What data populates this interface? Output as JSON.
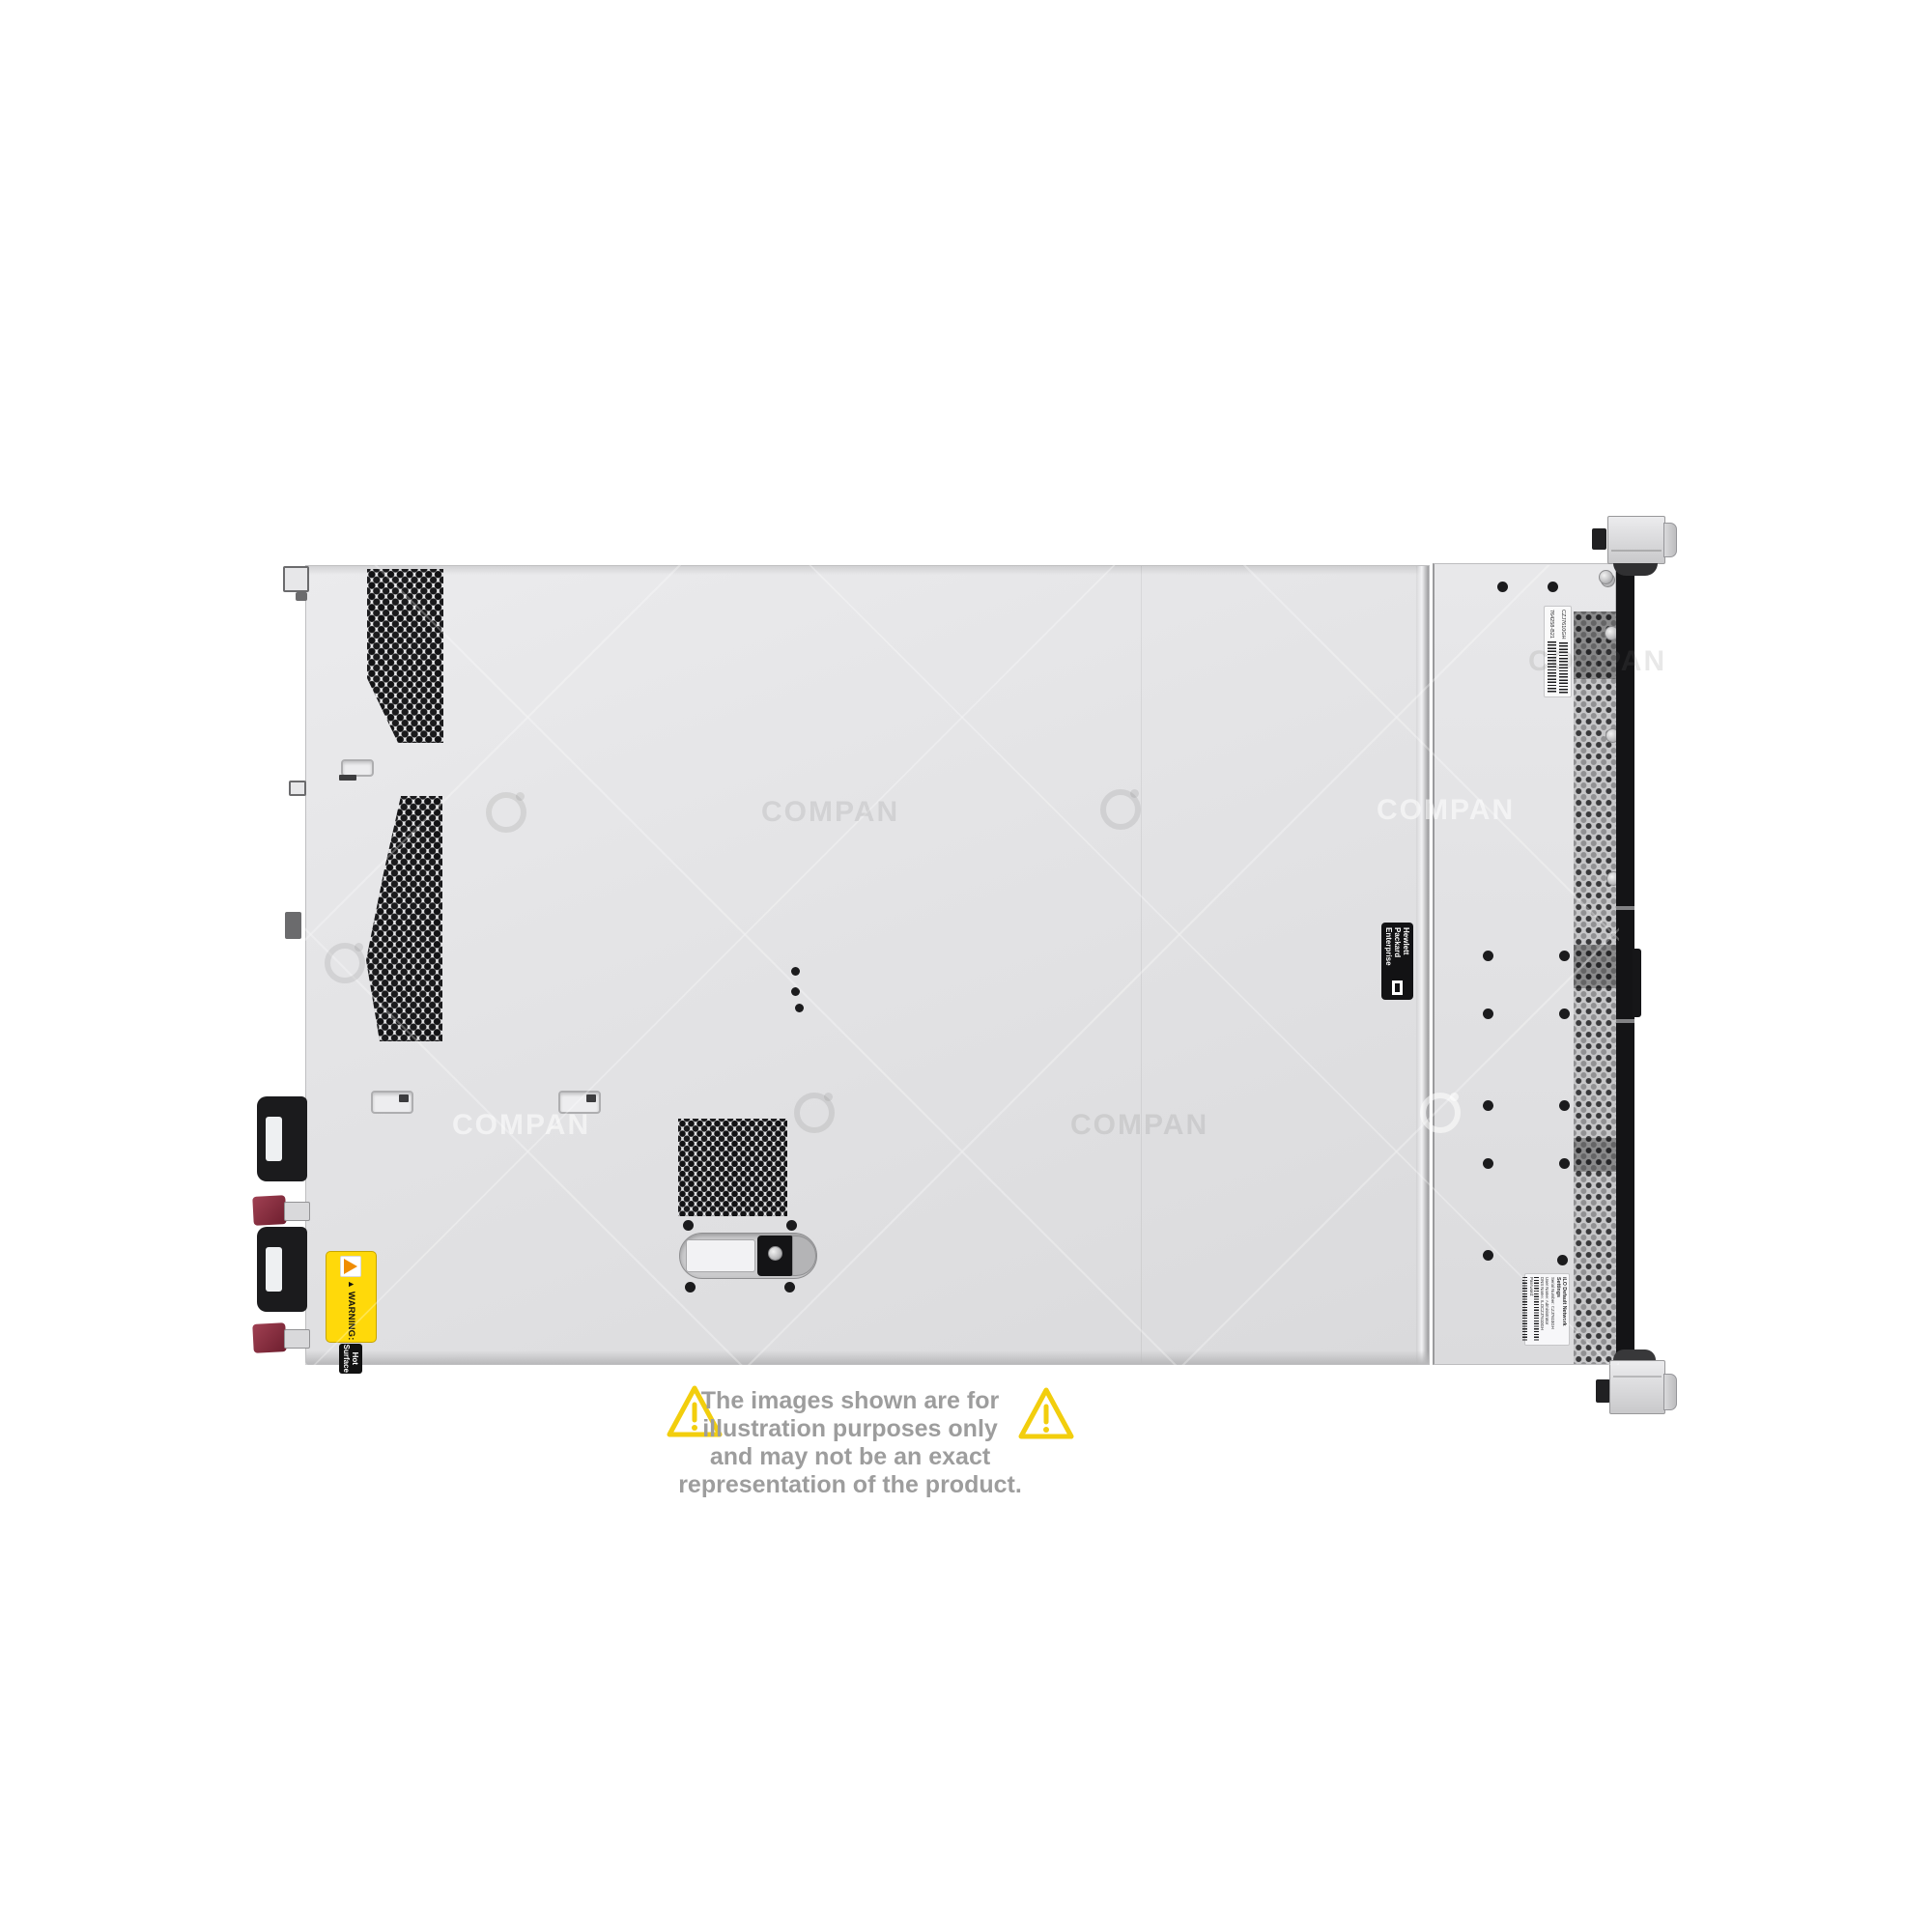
{
  "product_photo": {
    "description": "HPE 1U rack server, top view, rotated with front panel at right",
    "chassis_color": "#e3e3e5",
    "bezel_color": "#141416",
    "accent_yellow": "#ffd90a",
    "handle_maroon": "#8e3242"
  },
  "labels": {
    "warning": {
      "title": "WARNING:",
      "subtitle": "Hot Surface"
    },
    "hpe": {
      "line1": "Hewlett Packard",
      "line2": "Enterprise"
    },
    "barcode_label": {
      "serial": "CZJ7610GH",
      "part": "764258-B21"
    },
    "ilo": {
      "title": "iLO Default Network Settings",
      "line1": "Serial Number: CZJ7610GH",
      "line2": "User Name: Administrator",
      "line3": "DNS Name: ILOCZJ7610GH",
      "line4": "Password:"
    }
  },
  "watermark": {
    "text": "COMPAN"
  },
  "disclaimer": {
    "line1": "The images shown are for illustration purposes only",
    "line2": "and may not be an exact representation of the product."
  }
}
